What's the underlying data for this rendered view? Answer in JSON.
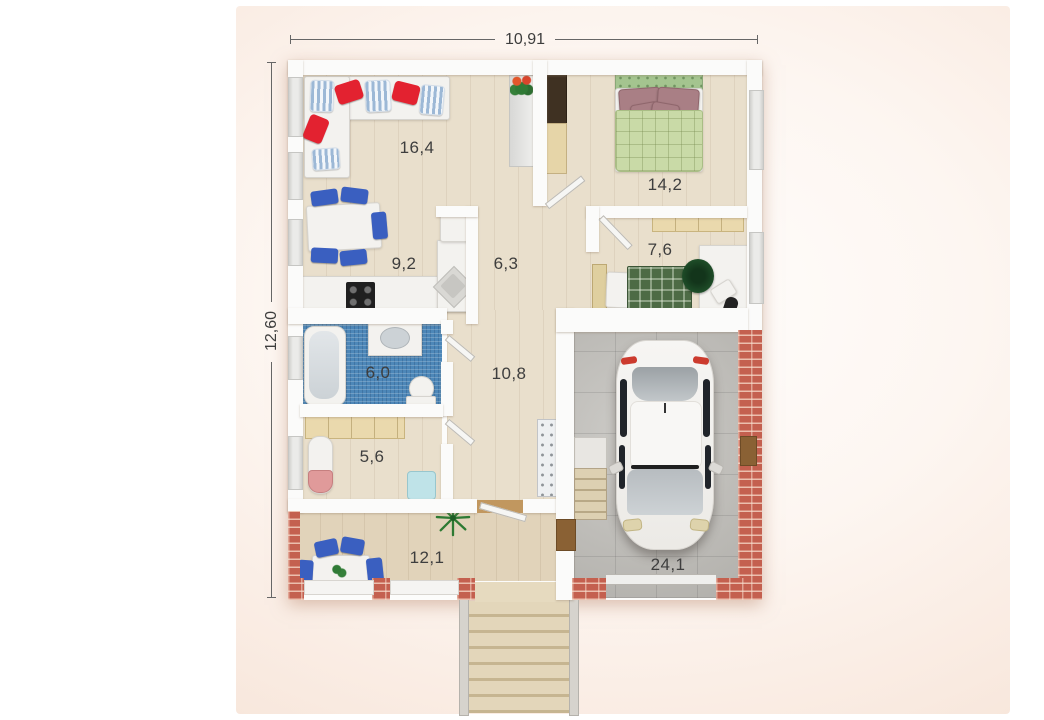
{
  "dimensions": {
    "width_total": "10,91",
    "height_total": "12,60"
  },
  "rooms": {
    "living": {
      "label": "16,4"
    },
    "dining": {
      "label": "9,2"
    },
    "hall": {
      "label": "6,3"
    },
    "bedroom": {
      "label": "14,2"
    },
    "office": {
      "label": "7,6"
    },
    "bathroom": {
      "label": "6,0"
    },
    "corridor": {
      "label": "10,8"
    },
    "utility": {
      "label": "5,6"
    },
    "terrace": {
      "label": "12,1"
    },
    "garage": {
      "label": "24,1"
    }
  },
  "colors": {
    "wall": "#fbfbfa",
    "wood_floor": "#e9dfcc",
    "terrace_floor": "#e1d3ba",
    "bath_tile": "#4d87b8",
    "garage_floor": "#bdbbb6",
    "brick": "#c4604f",
    "accent_red": "#e32230",
    "accent_blue": "#3a5fc0",
    "bed_green": "#c9daa7",
    "pillow_mauve": "#a97f85",
    "plaid_green": "#4d6b45",
    "cabinet_beige": "#ead9ad",
    "label_text": "#3e3e3e",
    "dim_line": "#666666"
  }
}
